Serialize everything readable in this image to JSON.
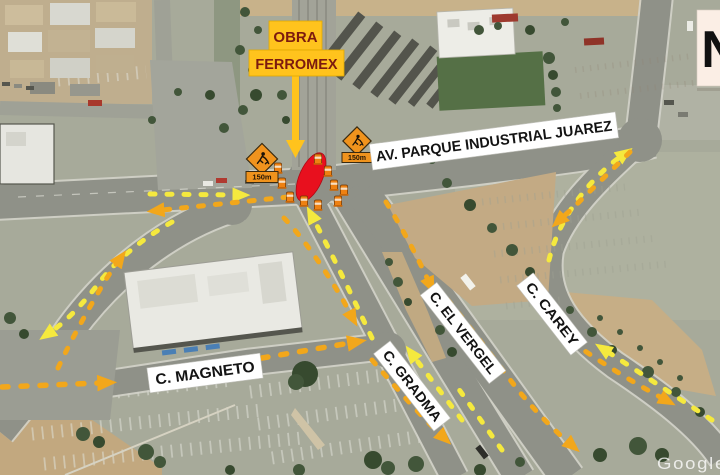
{
  "map": {
    "callout": {
      "line1": "OBRA",
      "line2": "FERROMEX"
    },
    "street_labels": {
      "avenue": "AV. PARQUE INDUSTRIAL JUAREZ",
      "vergel": "C. EL VERGEL",
      "carey": "C. CAREY",
      "gradma": "C. GRADMA",
      "magneto": "C. MAGNETO"
    },
    "work_signs": {
      "left_distance": "150m",
      "right_distance": "150m"
    },
    "compass": {
      "label": "N"
    },
    "watermark": {
      "text": "Google"
    },
    "colors": {
      "callout_bg": "#FFC31D",
      "callout_text": "#7C1B0F",
      "closure_zone_red": "#E8101E",
      "detour_yellow": "#F5E93E",
      "detour_orange": "#F2A71B",
      "sign_orange": "#F0931D",
      "street_label_bg": "#FFFFFF",
      "compass_bg": "#FBEEE5"
    }
  }
}
